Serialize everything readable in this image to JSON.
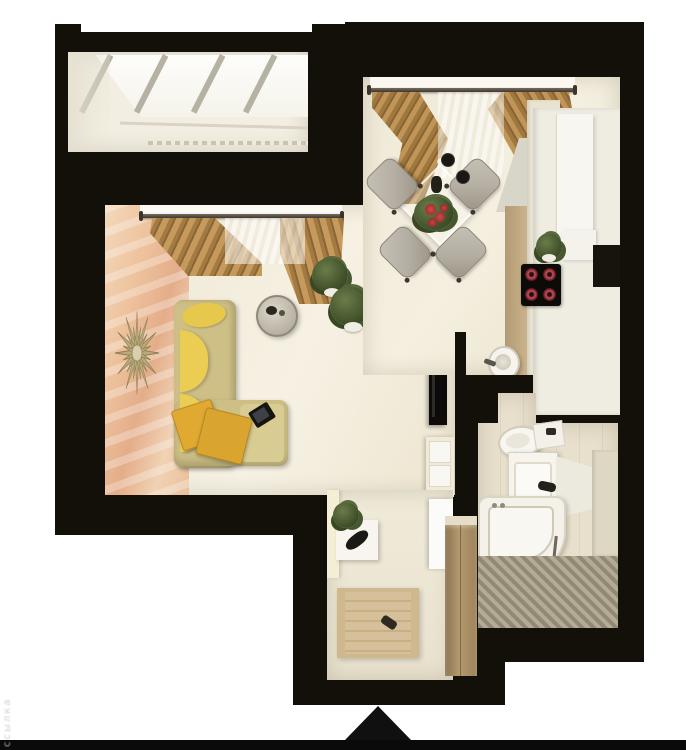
{
  "watermark": {
    "text": "ссылка"
  },
  "icons": {
    "entrance_arrow": "triangle-up"
  },
  "palette": {
    "wall_black": "#121009",
    "page_white": "#ffffff",
    "floor_cream": "#efe8d6",
    "accent_peach": "#edc49f",
    "curtain_tan": "#b48a4e",
    "sofa_yellow": "#e6c84d",
    "sofa_frame": "#cdbf85",
    "pillow_gold": "#dfa932",
    "chair_gray": "#b5afa3",
    "wood_brown": "#a78c63",
    "tray_wood": "#d5c09b",
    "burner_red": "#7e232d",
    "plant_green": "#3f5029",
    "mosaic_gray": "#b3ada0",
    "bath_beige": "#e8e0cc"
  }
}
